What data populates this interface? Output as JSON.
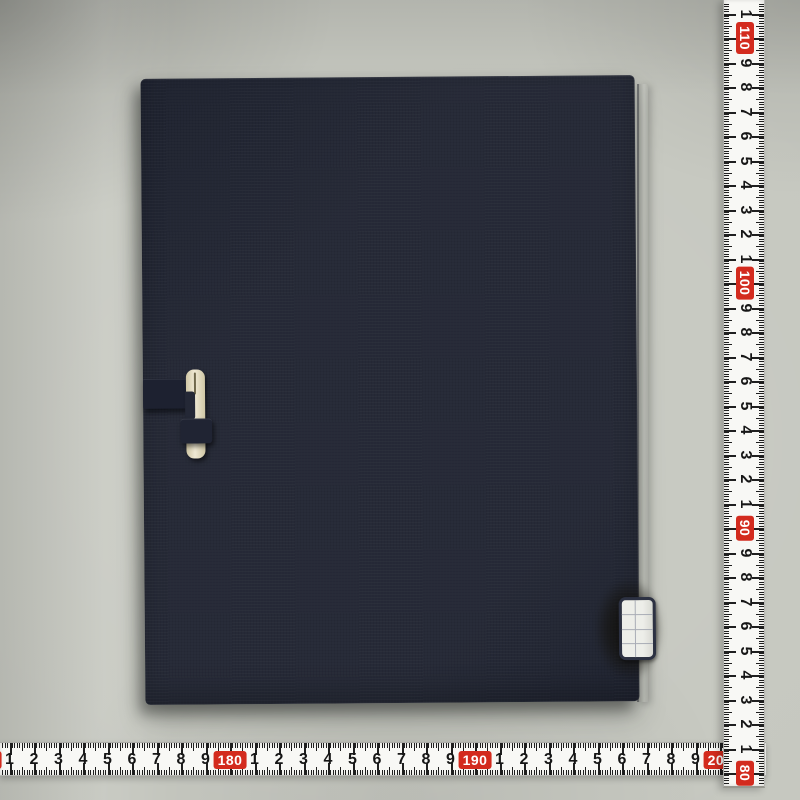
{
  "scene": {
    "subject": "dark navy cloth-covered book case photographed on gray surface with measuring tapes",
    "background_color": "#c6c8c0"
  },
  "book": {
    "x": 143,
    "y": 77,
    "width": 494,
    "height": 626,
    "rotation_deg": -0.45,
    "cover_color": "#262a37",
    "cover_shade": "#1f2330",
    "edge_strip": {
      "x": 637,
      "y": 84,
      "width": 9,
      "height": 618
    },
    "clasp": {
      "strap": {
        "x": 0,
        "y": 300,
        "width": 57,
        "height": 29,
        "color": "#1d2130"
      },
      "bone": {
        "x": 43,
        "y": 291,
        "width": 19,
        "height": 89,
        "color_light": "#efe9d4",
        "color_dark": "#cfc6a4"
      },
      "slit": {
        "x": 51,
        "y": 294,
        "width": 2,
        "height": 22,
        "color": "#6f684c"
      },
      "notch": {
        "x": 42,
        "y": 313,
        "width": 10,
        "height": 28,
        "color": "#242836"
      },
      "loop": {
        "x": 37,
        "y": 340,
        "width": 32,
        "height": 24,
        "color": "#202433"
      }
    },
    "smudge": {
      "x": 450,
      "y": 503,
      "width": 68,
      "height": 102
    },
    "label": {
      "x": 474,
      "y": 522,
      "width": 37,
      "height": 63,
      "fill": "#edeee9",
      "fill_edge": "#d8d9d3",
      "border_color": "#2c3142",
      "grid_color": "#a9adb6",
      "v_line_pct": 42,
      "h_line_pcts": [
        25,
        50,
        75
      ]
    }
  },
  "rulers": {
    "px_per_cm": 24.5,
    "tape_color": "#f8f8f5",
    "tick_color": "#1f1f1f",
    "red_color": "#d32b1e",
    "red_text_color": "#ffffff",
    "unit": "cm",
    "vertical": {
      "x": 723,
      "y": 0,
      "width": 42,
      "length": 788,
      "origin_value": 100,
      "origin_px": 283,
      "min_value": 79,
      "max_value": 112,
      "red_labels_visible": [
        "110",
        "100",
        "90",
        "80"
      ],
      "digit_labels": "1-9 between each red ten-mark, rotated 90deg"
    },
    "horizontal": {
      "x": 0,
      "y": 742,
      "length": 766,
      "width": 34,
      "origin_value": 180,
      "origin_px": 230,
      "min_value": 170,
      "max_value": 201,
      "red_labels_visible": [
        "170",
        "180",
        "190",
        "200"
      ],
      "digit_labels": "1-9 between each red ten-mark, upright"
    }
  }
}
